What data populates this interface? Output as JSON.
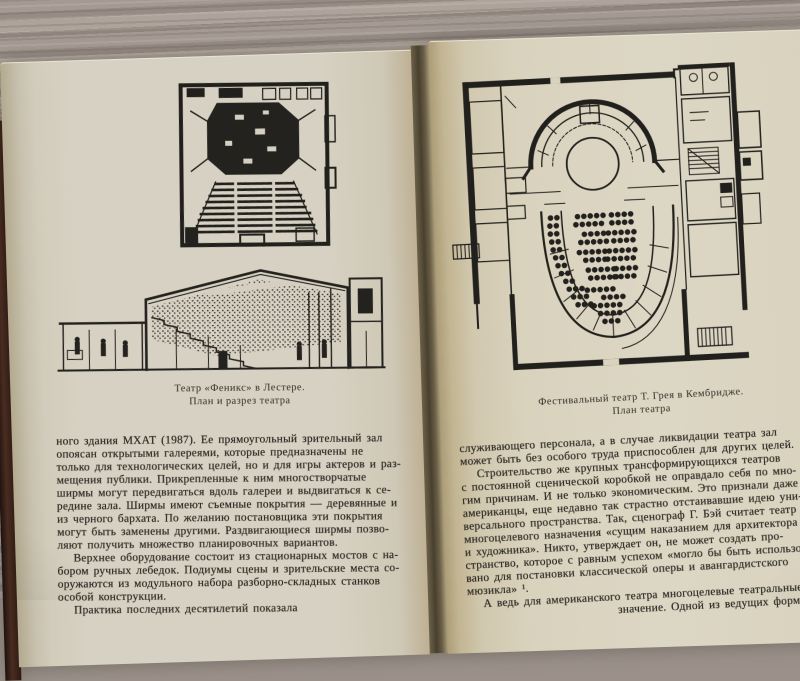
{
  "book": {
    "left_page": {
      "caption": [
        "Театр «Феникс» в Лестере.",
        "План и разрез театра"
      ],
      "body_lines": [
        "ного здания МХАТ (1987). Ее прямоугольный зрительный зал",
        "опоясан открытыми галереями, которые предназначены не",
        "только для технологических целей, но и для игры актеров и раз-",
        "мещения публики. Прикрепленные к ним многостворчатые",
        "ширмы могут передвигаться вдоль галереи и выдвигаться к се-",
        "редине зала. Ширмы имеют съемные покрытия — деревянные и",
        "из черного бархата. По желанию постановщика эти покрытия",
        "могут быть заменены другими. Раздвигающиеся ширмы позво-",
        "ляют получить множество планировочных вариантов.",
        "Верхнее оборудование состоит из стационарных мостов с на-",
        "бором ручных лебедок. Подиумы сцены и зрительские места со-",
        "оружаются из модульного набора разборно-складных станков",
        "особой конструкции.",
        "Практика последних десятилетий показала"
      ]
    },
    "right_page": {
      "caption": [
        "Фестивальный театр Т. Грея в Кембридже.",
        "План театра"
      ],
      "body_lines": [
        "служивающего персонала, а в случае ликвидации театра зал",
        "может быть без особого труда приспособлен для других целей.",
        "Строительство же крупных трансформирующихся театров",
        "с постоянной сценической коробкой не оправдало себя по мно-",
        "гим причинам. И не только экономическим. Это признали даже",
        "американцы, еще недавно так страстно отстаивавшие идею уни-",
        "версального пространства. Так, сценограф Г. Бэй считает театр",
        "многоцелевого назначения «сущим наказанием для архитектора",
        "и художника». Никто, утверждает он, не может создать про-",
        "странство, которое с равным успехом «могло бы быть использо-",
        "вано для постановки классической оперы и авангардистского",
        "мюзикла» ¹.",
        "А ведь для американского театра многоцелевые театральные",
        "значение. Одной из ведущих форм театраль-"
      ]
    },
    "colors": {
      "wood": "#9b918a",
      "page_left": "#d6d1c2",
      "page_right": "#dad3bf",
      "gutter_shadow": "#483f2d",
      "cover_edge": "#2a1a13",
      "ink": "#2b2822"
    }
  }
}
